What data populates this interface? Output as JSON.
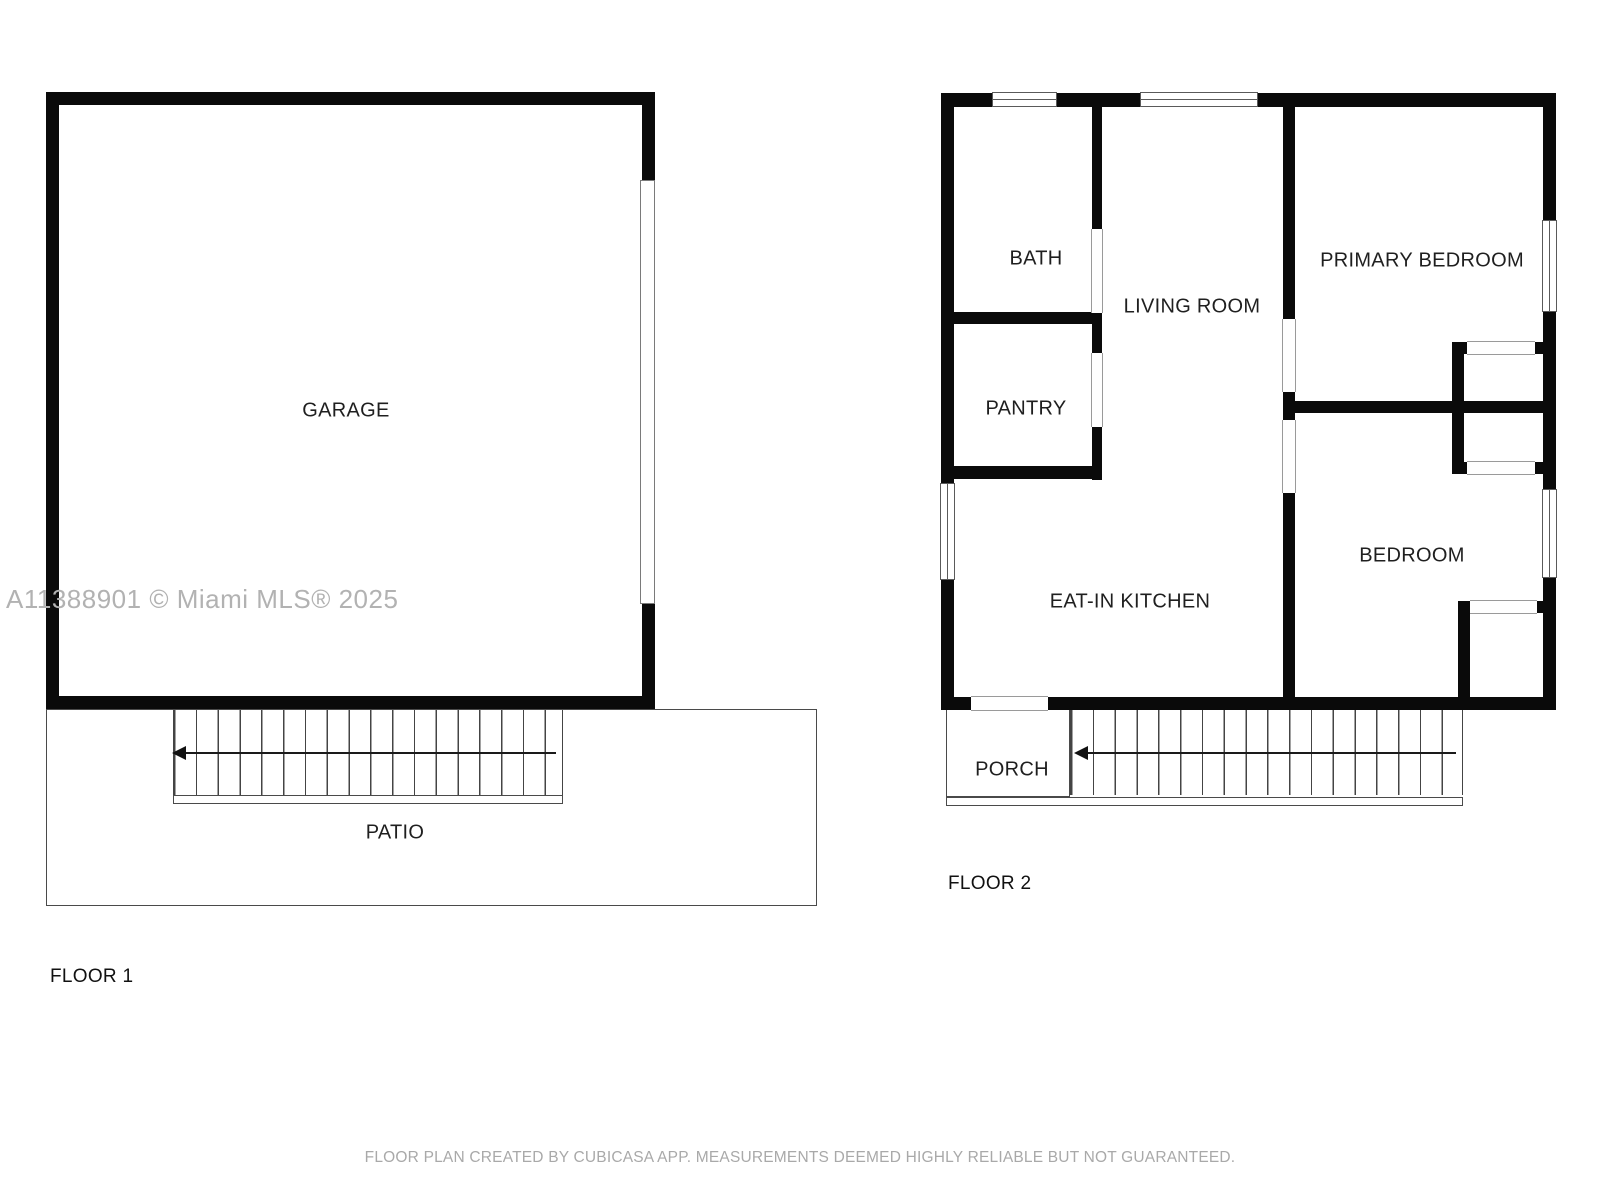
{
  "watermark": "A11388901 © Miami MLS® 2025",
  "footer": "FLOOR PLAN CREATED BY CUBICASA APP. MEASUREMENTS DEEMED HIGHLY RELIABLE BUT NOT GUARANTEED.",
  "floor1": {
    "label": "FLOOR 1",
    "rooms": {
      "garage": "GARAGE",
      "patio": "PATIO"
    }
  },
  "floor2": {
    "label": "FLOOR 2",
    "rooms": {
      "bath": "BATH",
      "pantry": "PANTRY",
      "living_room": "LIVING ROOM",
      "primary_bedroom": "PRIMARY BEDROOM",
      "eat_in_kitchen": "EAT-IN KITCHEN",
      "bedroom": "BEDROOM",
      "porch": "PORCH"
    }
  },
  "colors": {
    "wall": "#0a0a0a",
    "thin_line": "#4a4a4a",
    "label_text": "#1f1f1f",
    "muted_text": "#a9a9a9",
    "watermark_text": "#b2b2b2",
    "background": "#ffffff"
  }
}
